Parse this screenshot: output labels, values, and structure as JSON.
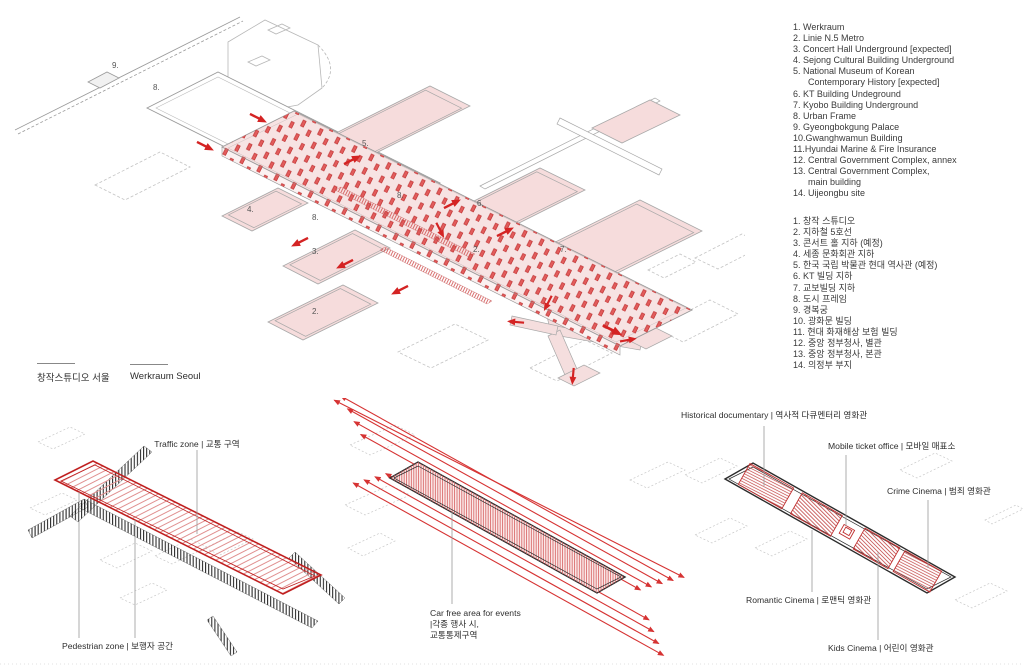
{
  "title": "Werkraum Seoul site diagrams",
  "colors": {
    "accent_red": "#d42323",
    "strip_pink": "#f7e3e3",
    "outline_gray": "#9a9a9a",
    "dark_outline": "#2b2b2b",
    "road_black": "#1a1a1a",
    "text": "#3a3a3a"
  },
  "legend_en": {
    "items": [
      "1. Werkraum",
      "2. Linie N.5 Metro",
      "3. Concert Hall Underground [expected]",
      "4. Sejong Cultural Building Underground",
      "5. National Museum of Korean\nContemporary History [expected]",
      "6. KT Building Undeground",
      "7. Kyobo Building Underground",
      "8. Urban Frame",
      "9. Gyeongbokgung Palace",
      "10.Gwanghwamun Building",
      "11.Hyundai Marine & Fire Insurance",
      "12. Central Government Complex, annex",
      "13. Central Government Complex,\nmain building",
      "14. Uijeongbu site"
    ]
  },
  "legend_ko": {
    "items": [
      "1. 창작 스튜디오",
      "2. 지하철 5호선",
      "3. 콘서트 홀 지하 (예정)",
      "4. 세종 문화회관 지하",
      "5. 한국 국립 박물관 현대 역사관 (예정)",
      "6. KT 빌딩 지하",
      "7. 교보빌딩 지하",
      "8. 도시 프레임",
      "9. 경복궁",
      "10. 광화문 빌딩",
      "11. 현대 화재해상 보험 빌딩",
      "12. 중앙 정부청사, 별관",
      "13. 중앙 정부청사, 본관",
      "14. 의정부 부지"
    ]
  },
  "caption": {
    "ko": "창작스튜디오 서울",
    "en": "Werkraum Seoul"
  },
  "main_labels": {
    "l9": "9.",
    "l8a": "8.",
    "l5": "5.",
    "l8b": "8.",
    "l4": "4.",
    "l8c": "8.",
    "l3": "3.",
    "l2a": "2.",
    "l2b": "2.",
    "l6": "6.",
    "l7": "7."
  },
  "traffic_diagram": {
    "traffic_label": "Traffic zone | 교통 구역",
    "pedestrian_label": "Pedestrian zone | 보행자 공간"
  },
  "carfree_diagram": {
    "line1": "Car free area for events",
    "line2": "|각종 행사 시,",
    "line3": "교통통제구역"
  },
  "cinema_diagram": {
    "historical": "Historical documentary | 역사적 다큐멘터리 영화관",
    "ticket": "Mobile ticket office | 모바일 매표소",
    "crime": "Crime Cinema | 범죄 영화관",
    "romantic": "Romantic Cinema | 로맨틱 영화관",
    "kids": "Kids Cinema | 어린이 영화관"
  }
}
